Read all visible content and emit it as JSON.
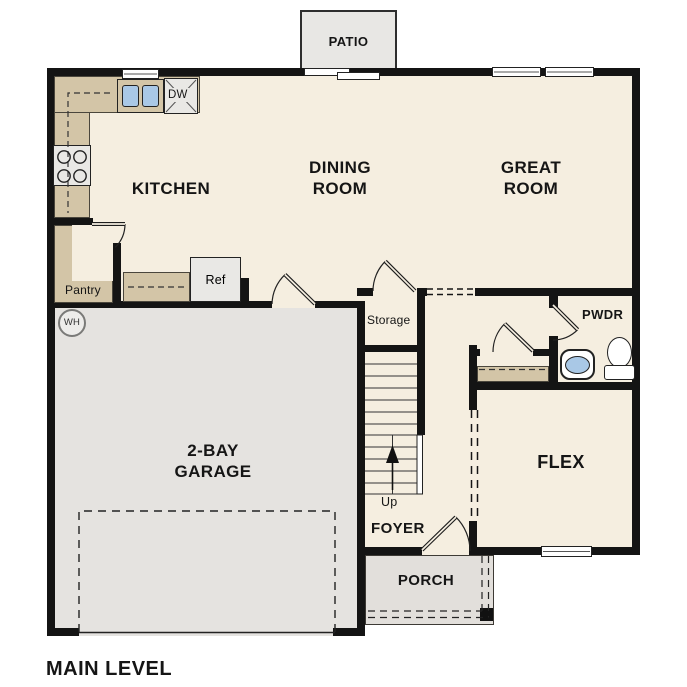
{
  "plan_title": "MAIN LEVEL",
  "colors": {
    "wall": "#141414",
    "floor": "#f5eee0",
    "garage": "#e5e3e0",
    "porch": "#e2dfdb",
    "patio": "#e8e7e4",
    "counter": "#d3c5a7",
    "appliance": "#e9e8e5",
    "sinkblue": "#a9c8e6",
    "line": "#222222"
  },
  "rooms": {
    "kitchen": "KITCHEN",
    "dining_1": "DINING",
    "dining_2": "ROOM",
    "great_1": "GREAT",
    "great_2": "ROOM",
    "garage_1": "2-BAY",
    "garage_2": "GARAGE",
    "flex": "FLEX",
    "foyer": "FOYER",
    "porch": "PORCH",
    "patio": "PATIO",
    "pwdr": "PWDR",
    "storage": "Storage",
    "pantry": "Pantry"
  },
  "fixtures": {
    "refrigerator": "Ref",
    "dishwasher": "DW",
    "water_heater": "WH",
    "stairs_up": "Up"
  }
}
